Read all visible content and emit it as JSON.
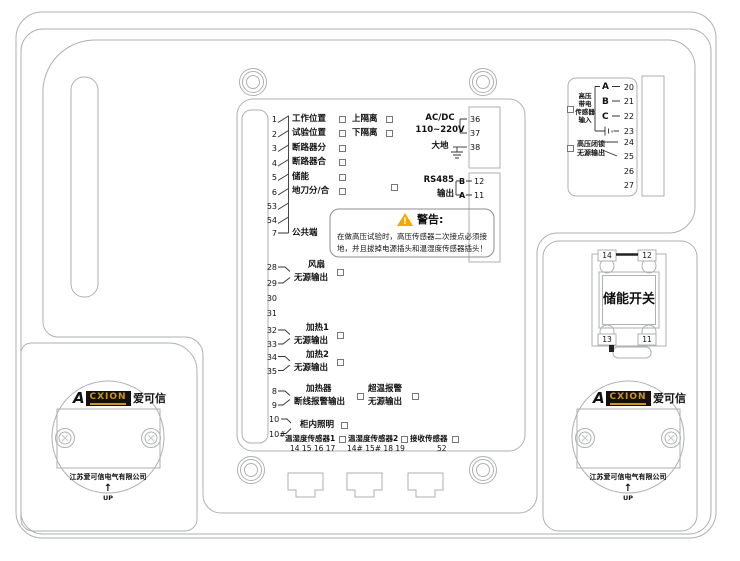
{
  "io": {
    "rows": [
      {
        "no": "1",
        "label": "工作位置",
        "label2": "上隔离"
      },
      {
        "no": "2",
        "label": "试验位置",
        "label2": "下隔离"
      },
      {
        "no": "3",
        "label": "断路器分"
      },
      {
        "no": "4",
        "label": "断路器合"
      },
      {
        "no": "5",
        "label": "储能"
      },
      {
        "no": "6",
        "label": "地刀分/合"
      },
      {
        "no": "53"
      },
      {
        "no": "54"
      },
      {
        "no": "7",
        "label": "公共端"
      }
    ],
    "power": {
      "l1": "AC/DC",
      "l2": "110~220V",
      "n36": "36",
      "n37": "37",
      "earth": "大地",
      "n38": "38"
    },
    "rs485": {
      "l1": "RS485",
      "l2": "输出",
      "pb": "B",
      "n12": "12",
      "pa": "A",
      "n11": "11"
    },
    "warning": {
      "mark": "!",
      "title": "警告:",
      "body1": "在做高压试验时，高压传感器二次接点必须接",
      "body2": "地，并且拔掉电源插头和温湿度传感器插头！"
    },
    "outputs": [
      {
        "n1": "28",
        "n2": "29",
        "l1": "风扇",
        "l2": "无源输出"
      },
      {
        "n1": "30",
        "n2": "31"
      },
      {
        "n1": "32",
        "n2": "33",
        "l1": "加热1",
        "l2": "无源输出"
      },
      {
        "n1": "34",
        "n2": "35",
        "l1": "加热2",
        "l2": "无源输出"
      },
      {
        "n1": "8",
        "n2": "9",
        "l1": "加热器",
        "l2": "断线报警输出",
        "r1": "超温报警",
        "r2": "无源输出"
      },
      {
        "n1": "10",
        "n2": "10#",
        "l1": "柜内照明"
      }
    ],
    "sensors": {
      "s1": "温湿度传感器1",
      "s1n": "14 15 16 17",
      "s2": "温湿度传感器2",
      "s2n": "14# 15# 18 19",
      "s3": "接收传感器",
      "s3n": "52"
    }
  },
  "hv": {
    "input_lines": [
      "高压",
      "带电",
      "传感器",
      "输入"
    ],
    "phases": [
      {
        "p": "A",
        "n": "20"
      },
      {
        "p": "B",
        "n": "21"
      },
      {
        "p": "C",
        "n": "22"
      }
    ],
    "nearth": "23",
    "n24": "24",
    "n25": "25",
    "n26": "26",
    "n27": "27",
    "interlock1": "高压闭锁",
    "interlock2": "无源输出"
  },
  "sw": {
    "title": "储能开关",
    "tl": "14",
    "tr": "12",
    "bl": "13",
    "br": "11"
  },
  "brand": {
    "a": "A",
    "box": "CXION",
    "cn": "爱可信",
    "company": "江苏爱可信电气有限公司",
    "up_arrow": "↑",
    "up": "UP"
  },
  "colors": {
    "line": "#a9abad",
    "ink": "#1a1a1a",
    "gold": "#c9971c",
    "warn": "#f6a800"
  }
}
